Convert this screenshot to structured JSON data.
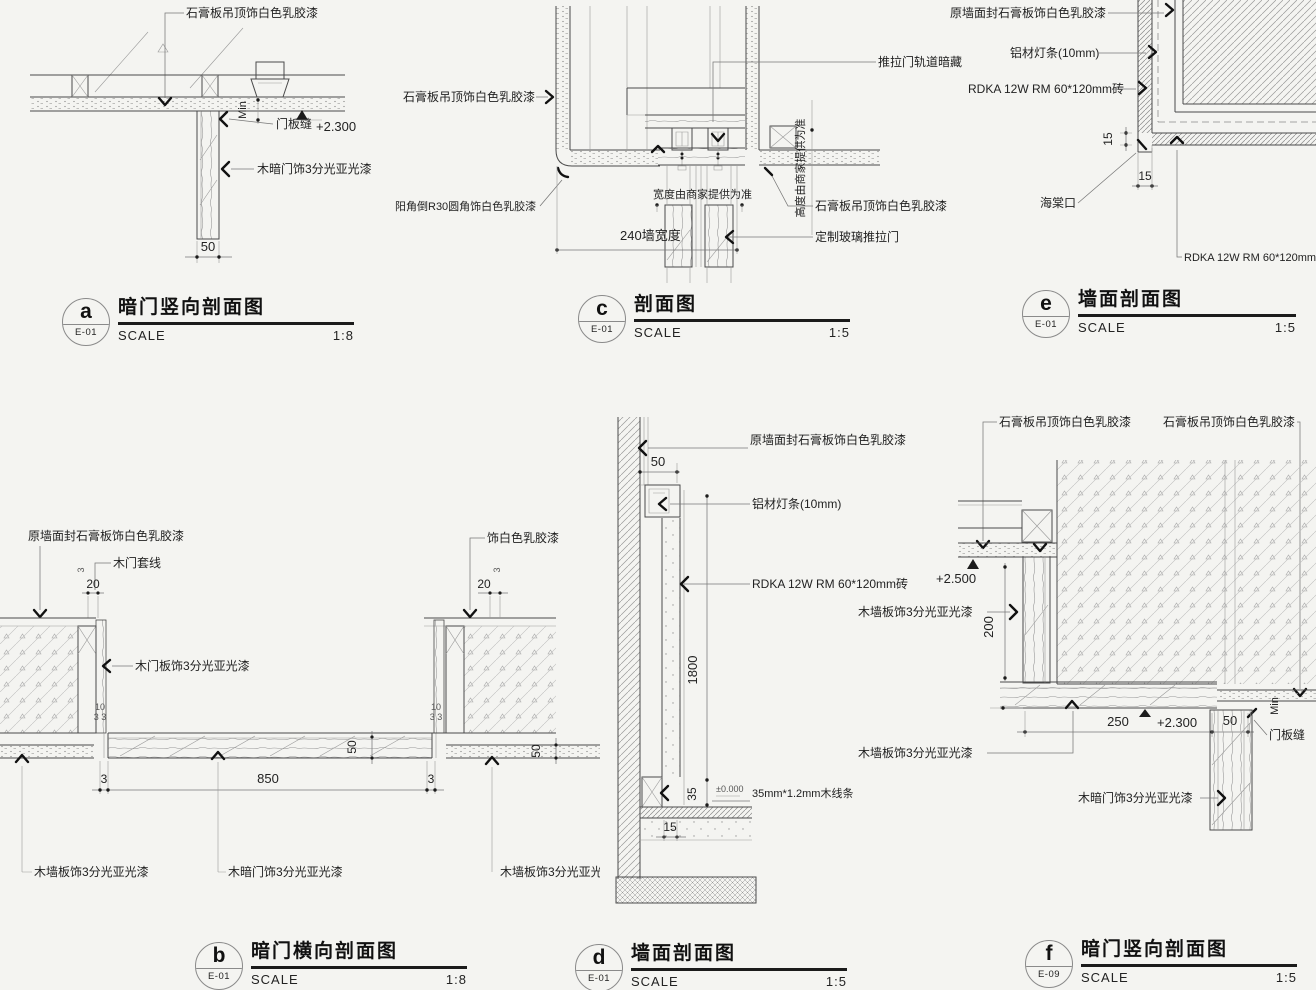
{
  "sheet": {
    "background": "#f4f4f1",
    "line_color": "#4a4a4a",
    "accent_dark": "#111111"
  },
  "details": {
    "a": {
      "letter": "a",
      "code": "E-01",
      "title": "暗门竖向剖面图",
      "scale_label": "SCALE",
      "scale": "1:8",
      "labels": {
        "ceiling": "石膏板吊顶饰白色乳胶漆",
        "min": "Min",
        "door_seam": "门板缝",
        "elev": "+2.300",
        "hidden_door": "木暗门饰3分光亚光漆",
        "dim_50": "50"
      }
    },
    "b": {
      "letter": "b",
      "code": "E-01",
      "title": "暗门横向剖面图",
      "scale_label": "SCALE",
      "scale": "1:8",
      "labels": {
        "wall_seal": "原墙面封石膏板饰白色乳胶漆",
        "casing": "木门套线",
        "dim_3l": "3",
        "dim_20l": "20",
        "door_panel": "木门板饰3分光亚光漆",
        "paint": "饰白色乳胶漆",
        "dim_3r": "3",
        "dim_20r": "20",
        "dim_10l": "10",
        "dim_33l": "3 3",
        "dim_10r": "10",
        "dim_33r": "3 3",
        "dim_50a": "50",
        "dim_50b": "50",
        "dim_3a": "3",
        "dim_850": "850",
        "dim_3b": "3",
        "wall_left": "木墙板饰3分光亚光漆",
        "hidden_door": "木暗门饰3分光亚光漆",
        "wall_right": "木墙板饰3分光亚光漆"
      }
    },
    "c": {
      "letter": "c",
      "code": "E-01",
      "title": "剖面图",
      "scale_label": "SCALE",
      "scale": "1:5",
      "labels": {
        "ceiling_left": "石膏板吊顶饰白色乳胶漆",
        "corner": "阳角倒R30圆角饰白色乳胶漆",
        "track": "推拉门轨道暗藏",
        "width_note": "宽度由商家提供为准",
        "wall_240": "240墙宽度",
        "height_note": "高度由商家提供为准",
        "ceiling_right": "石膏板吊顶饰白色乳胶漆",
        "glass_door": "定制玻璃推拉门"
      }
    },
    "d": {
      "letter": "d",
      "code": "E-01",
      "title": "墙面剖面图",
      "scale_label": "SCALE",
      "scale": "1:5",
      "labels": {
        "wall_seal": "原墙面封石膏板饰白色乳胶漆",
        "dim_50": "50",
        "light_strip": "铝材灯条(10mm)",
        "tile": "RDKA 12W RM 60*120mm砖",
        "dim_1800": "1800",
        "dim_35": "35",
        "elev_0": "±0.000",
        "trim": "35mm*1.2mm木线条",
        "dim_15": "15"
      }
    },
    "e": {
      "letter": "e",
      "code": "E-01",
      "title": "墙面剖面图",
      "scale_label": "SCALE",
      "scale": "1:5",
      "labels": {
        "wall_seal": "原墙面封石膏板饰白色乳胶漆",
        "light_strip": "铝材灯条(10mm)",
        "tile": "RDKA 12W RM 60*120mm砖",
        "dim_15v": "15",
        "dim_15h": "15",
        "haitang": "海棠口",
        "tile_2": "RDKA 12W RM 60*120mm砖"
      }
    },
    "f": {
      "letter": "f",
      "code": "E-09",
      "title": "暗门竖向剖面图",
      "scale_label": "SCALE",
      "scale": "1:5",
      "labels": {
        "ceiling_1": "石膏板吊顶饰白色乳胶漆",
        "ceiling_2": "石膏板吊顶饰白色乳胶漆",
        "elev_2500": "+2.500",
        "wall_panel_1": "木墙板饰3分光亚光漆",
        "dim_200": "200",
        "dim_250": "250",
        "elev_2300": "+2.300",
        "dim_50": "50",
        "min": "Min",
        "door_seam": "门板缝",
        "wall_panel_2": "木墙板饰3分光亚光漆",
        "hidden_door": "木暗门饰3分光亚光漆"
      }
    }
  }
}
